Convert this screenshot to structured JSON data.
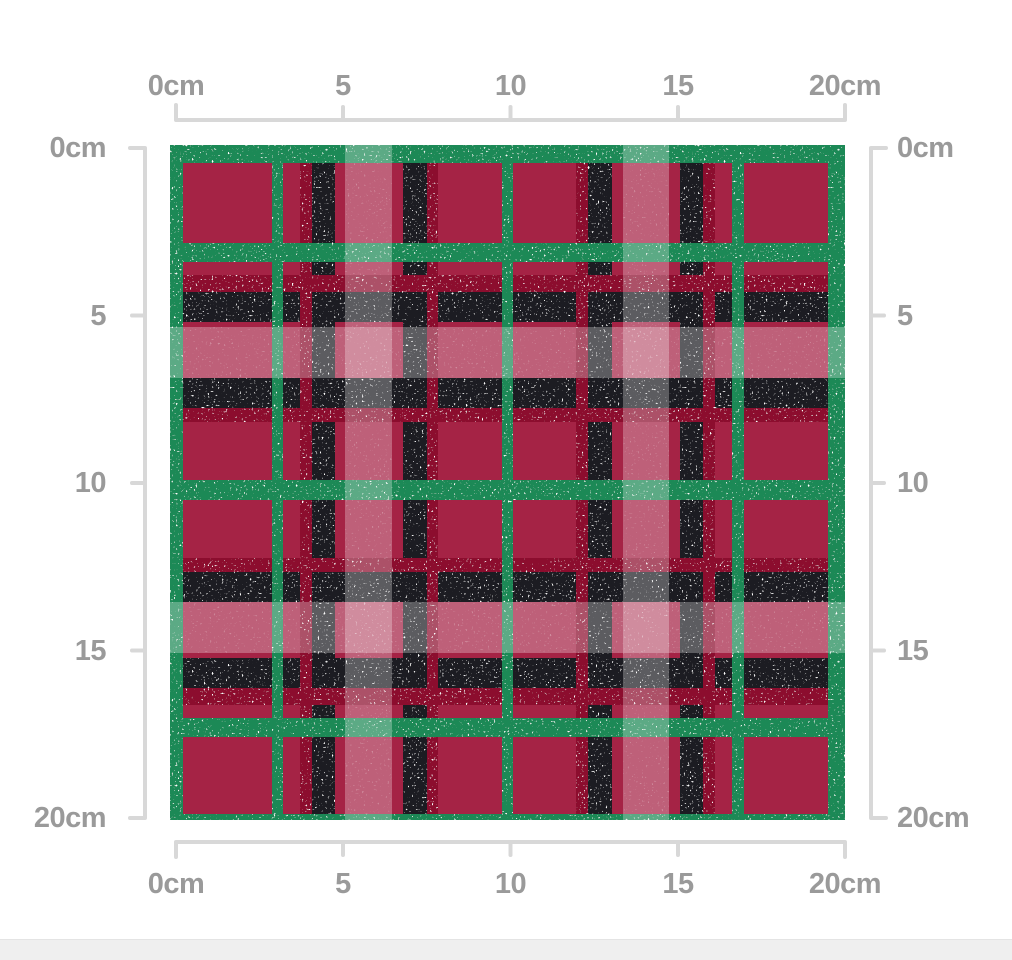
{
  "rulers": {
    "labels": [
      "0cm",
      "5",
      "10",
      "15",
      "20cm"
    ],
    "label_color": "#9a9a9a",
    "line_color": "#d8d8d8"
  },
  "swatch": {
    "description": "red, green and black glitter tartan plaid fabric swatch preview, 20cm x 20cm",
    "size_cm": 20,
    "px": 675,
    "background_color": "#a52345",
    "band_colors": {
      "black": "#1e1e23",
      "crimson": "#8c0e2d",
      "green": "#1d8956",
      "light": "rgba(255,255,255,0.28)"
    },
    "bands": [
      {
        "orientation": "h",
        "color": "black",
        "pos": 147,
        "size": 30
      },
      {
        "orientation": "h",
        "color": "black",
        "pos": 233,
        "size": 30
      },
      {
        "orientation": "h",
        "color": "black",
        "pos": 427,
        "size": 30
      },
      {
        "orientation": "h",
        "color": "black",
        "pos": 513,
        "size": 30
      },
      {
        "orientation": "v",
        "color": "black",
        "pos": 142,
        "size": 23
      },
      {
        "orientation": "v",
        "color": "black",
        "pos": 233,
        "size": 24
      },
      {
        "orientation": "v",
        "color": "black",
        "pos": 418,
        "size": 24
      },
      {
        "orientation": "v",
        "color": "black",
        "pos": 510,
        "size": 23
      },
      {
        "orientation": "h",
        "color": "crimson",
        "pos": 130,
        "size": 17
      },
      {
        "orientation": "h",
        "color": "crimson",
        "pos": 263,
        "size": 14
      },
      {
        "orientation": "h",
        "color": "crimson",
        "pos": 413,
        "size": 14
      },
      {
        "orientation": "h",
        "color": "crimson",
        "pos": 543,
        "size": 17
      },
      {
        "orientation": "v",
        "color": "crimson",
        "pos": 130,
        "size": 12
      },
      {
        "orientation": "v",
        "color": "crimson",
        "pos": 257,
        "size": 11
      },
      {
        "orientation": "v",
        "color": "crimson",
        "pos": 406,
        "size": 12
      },
      {
        "orientation": "v",
        "color": "crimson",
        "pos": 533,
        "size": 12
      },
      {
        "orientation": "h",
        "color": "green",
        "pos": 0,
        "size": 18
      },
      {
        "orientation": "h",
        "color": "green",
        "pos": 98,
        "size": 19
      },
      {
        "orientation": "h",
        "color": "green",
        "pos": 335,
        "size": 20
      },
      {
        "orientation": "h",
        "color": "green",
        "pos": 573,
        "size": 19
      },
      {
        "orientation": "h",
        "color": "green",
        "pos": 669,
        "size": 6
      },
      {
        "orientation": "v",
        "color": "green",
        "pos": 0,
        "size": 13
      },
      {
        "orientation": "v",
        "color": "green",
        "pos": 102,
        "size": 11
      },
      {
        "orientation": "v",
        "color": "green",
        "pos": 332,
        "size": 11
      },
      {
        "orientation": "v",
        "color": "green",
        "pos": 562,
        "size": 12
      },
      {
        "orientation": "v",
        "color": "green",
        "pos": 658,
        "size": 17
      },
      {
        "orientation": "h",
        "color": "light",
        "pos": 182,
        "size": 51
      },
      {
        "orientation": "h",
        "color": "light",
        "pos": 457,
        "size": 51
      },
      {
        "orientation": "v",
        "color": "light",
        "pos": 175,
        "size": 47
      },
      {
        "orientation": "v",
        "color": "light",
        "pos": 453,
        "size": 46
      }
    ]
  },
  "bottom_bar": {
    "color": "#efefef"
  }
}
